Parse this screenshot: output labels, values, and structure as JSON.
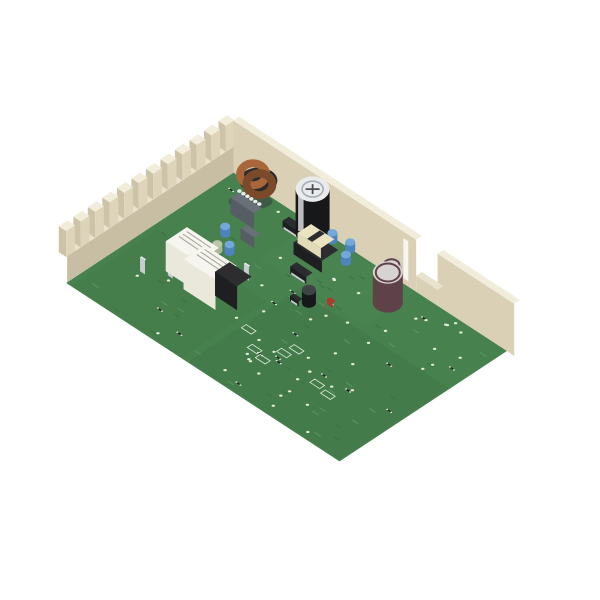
{
  "meta": {
    "alt": "Appliance control circuit board with relays on a green PCB inside a cream crenellated plastic enclosure, photographed on a white background"
  },
  "colors": {
    "background": "#ffffff",
    "wallTop": "#f2ecda",
    "wallTopDim": "#e9e2cd",
    "wallFaceLeft": "#e3dbc5",
    "wallFaceLeftLow": "#dcd3ba",
    "wallFaceRight": "#d6ccb2",
    "wallFaceRightLow": "#cfc5aa",
    "wallInner": "#d9d0b6",
    "wallInnerShadow": "#c8bea3",
    "toothSide": "#cdc3a8",
    "toothInner": "#ddd4ba",
    "railTop": "#eee7d3",
    "ledge": "#f0e9d6",
    "ledgeShadow": "#b8ae93",
    "slotDark": "#26251f",
    "slotShallow": "#6e6753",
    "slotWhite": "#f7f5ee",
    "holeTan": "#c2b89c",
    "tab": "#e6deca",
    "pcb": "#47814e",
    "pcbDark": "#3b7143",
    "pcbLight": "#5c9a63",
    "pad": "#e3ecdd",
    "relayTop": "#f7f5ef",
    "relayWest": "#d8d4c7",
    "relaySouth": "#eae7db",
    "relayText": "#a9a89c",
    "blackTop": "#2d2c2f",
    "blackWest": "#141317",
    "blackSouth": "#1f1e21",
    "grayTop": "#697078",
    "grayWest": "#464b52",
    "graySouth": "#575d64",
    "silver": "#c9cdd1",
    "silverDark": "#9aa0a6",
    "silverTop": "#e7eaec",
    "maroon": "#5e4149",
    "capTop": "#d8d3d3",
    "capTopDark": "#3f4246",
    "blackBody": "#17181a",
    "capTopWhite": "#e9ebec",
    "capRing": "#a8aeb4",
    "capStripe": "#d8dadc",
    "capVent": "#4a4e52",
    "blueCap": "#4c84bd",
    "blueCapTop": "#74a8da",
    "copper": "#a9663a",
    "copperDark": "#7a4a2a",
    "bobbin": "#ebe4c2",
    "bobbinSide": "#d6cfac",
    "bobbinSouth": "#e2dbb8",
    "redConnTop": "#bd4a3c",
    "redConnWest": "#8a2d24",
    "redConnSouth": "#a63728",
    "redTeeth": "#c4564a",
    "redSlab": "#a5382c",
    "redSmall": "#b03a30",
    "redSmallDark": "#7e2a22",
    "darkGreen": "#24382c",
    "darkGreenTop": "#2e4637",
    "darkGreenDark": "#16241c",
    "gold": "#c9a243",
    "qfpTop": "#26272b",
    "soicTop": "#2b2c30",
    "connTop": "#f0ead9",
    "connWest": "#d7d1be",
    "connSouth": "#e5dfcc",
    "connHole": "#3a3831",
    "paleGreen": "#b8c7a5",
    "paleGreenBody": "#a9b897",
    "toroidBase": "#2c2c2a"
  },
  "materials": {
    "relay": [
      "relayTop",
      "relayWest",
      "relaySouth"
    ],
    "blackRelay": [
      "blackTop",
      "blackWest",
      "blackSouth"
    ],
    "gray": [
      "grayTop",
      "grayWest",
      "graySouth"
    ],
    "spade": [
      "silverTop",
      "silverDark",
      "silver"
    ],
    "conn": [
      "connTop",
      "connWest",
      "connSouth"
    ],
    "blackConn": [
      "capTopDark",
      "blackWest",
      "blackSouth"
    ],
    "darkGreen": [
      "darkGreenTop",
      "darkGreenDark",
      "darkGreen"
    ],
    "redSmall": [
      "redSmall",
      "redSmallDark",
      "redSmall"
    ],
    "redConn": [
      "redConnTop",
      "redConnWest",
      "redConnSouth"
    ],
    "soicMat": [
      "soicTop",
      "blackWest",
      "blackSouth"
    ],
    "maroonCap": [
      "capTop",
      "maroon"
    ],
    "blackCap": [
      "capTopDark",
      "blackBody"
    ],
    "blueDisc": [
      "blueCapTop",
      "blueCap"
    ],
    "paleGreenMat": [
      "paleGreen",
      "paleGreenBody"
    ]
  },
  "scene": {
    "projection": {
      "ox": 232,
      "oy": 164,
      "ux": 0.6128,
      "uy": 0.4,
      "vx": -0.4838,
      "vy": 0.3189
    },
    "board": {
      "w": 470,
      "d": 370,
      "wall": 12
    },
    "components": [
      {
        "name": "toroid-inductor",
        "type": "toroid",
        "bx": 62,
        "by": 30
      },
      {
        "name": "film-capacitor-large",
        "type": "box",
        "m": "gray",
        "bx": 80,
        "by": 72,
        "w": 38,
        "d": 16,
        "h": 16
      },
      {
        "name": "film-capacitor-small",
        "type": "box",
        "m": "gray",
        "bx": 112,
        "by": 104,
        "w": 22,
        "d": 12,
        "h": 11
      },
      {
        "name": "electrolytic-capacitor-large",
        "type": "bigcap",
        "bx": 152,
        "by": 26,
        "r": 17,
        "h": 44
      },
      {
        "name": "transformer",
        "type": "transformer",
        "bx": 186,
        "by": 62,
        "w": 46,
        "d": 34,
        "h": 24
      },
      {
        "name": "electrolytic-capacitor-medium",
        "type": "cyl",
        "m": "maroonCap",
        "bx": 300,
        "by": 58,
        "r": 15,
        "h": 30
      },
      {
        "name": "electrolytic-capacitor-small",
        "type": "cyl",
        "m": "maroonCap",
        "bx": 284,
        "by": 30,
        "r": 10,
        "h": 22
      },
      {
        "name": "electrolytic-capacitor-mini",
        "type": "cyl",
        "m": "blackCap",
        "bx": 236,
        "by": 140,
        "r": 7,
        "h": 13
      },
      {
        "name": "connector-black",
        "type": "blackconn",
        "bx": 336,
        "by": 16,
        "w": 34,
        "d": 20,
        "h": 26
      },
      {
        "name": "connector-white-1",
        "type": "whiteconn",
        "bx": 388,
        "by": 34,
        "w": 30,
        "d": 24,
        "h": 24
      },
      {
        "name": "connector-white-2",
        "type": "whiteconn",
        "bx": 428,
        "by": 52,
        "w": 30,
        "d": 24,
        "h": 24
      },
      {
        "name": "connector-white-corner",
        "type": "whiteconn",
        "bx": 440,
        "by": 20,
        "w": 22,
        "d": 18,
        "h": 28
      },
      {
        "name": "component-dark-green",
        "type": "box",
        "m": "darkGreen",
        "bx": 454,
        "by": 40,
        "w": 14,
        "d": 20,
        "h": 16
      },
      {
        "name": "disc-capacitor-blue-1",
        "type": "cyl",
        "m": "blueDisc",
        "bx": 82,
        "by": 118,
        "r": 5,
        "h": 8
      },
      {
        "name": "disc-capacitor-blue-2",
        "type": "cyl",
        "m": "blueDisc",
        "bx": 108,
        "by": 142,
        "r": 5,
        "h": 8
      },
      {
        "name": "disc-capacitor-blue-3",
        "type": "cyl",
        "m": "blueDisc",
        "bx": 178,
        "by": 18,
        "r": 5,
        "h": 8
      },
      {
        "name": "disc-capacitor-blue-4",
        "type": "cyl",
        "m": "blueDisc",
        "bx": 204,
        "by": 14,
        "r": 5,
        "h": 8
      },
      {
        "name": "disc-capacitor-blue-5",
        "type": "cyl",
        "m": "blueDisc",
        "bx": 216,
        "by": 38,
        "r": 5,
        "h": 8
      },
      {
        "name": "ic-soic-1",
        "type": "soic",
        "bx": 134,
        "by": 42,
        "w": 26,
        "d": 13,
        "h": 7
      },
      {
        "name": "ic-soic-2",
        "type": "soic",
        "bx": 197,
        "by": 106,
        "w": 26,
        "d": 13,
        "h": 7
      },
      {
        "name": "ic-soic-3",
        "type": "soic",
        "bx": 293,
        "by": 158,
        "w": 26,
        "d": 13,
        "h": 7
      },
      {
        "name": "ic-soic-4",
        "type": "soic",
        "bx": 225,
        "by": 152,
        "w": 14,
        "d": 8,
        "h": 5
      },
      {
        "name": "microcontroller-qfp",
        "type": "qfp",
        "bx": 358,
        "by": 130,
        "w": 30,
        "d": 30,
        "h": 9
      },
      {
        "name": "pin-header",
        "type": "header",
        "bx": 399,
        "by": 148,
        "w": 30,
        "d": 12,
        "h": 9
      },
      {
        "name": "component-red-1",
        "type": "box",
        "m": "redSmall",
        "bx": 257,
        "by": 120,
        "w": 9,
        "d": 6,
        "h": 5
      },
      {
        "name": "component-red-2",
        "type": "box",
        "m": "redSmall",
        "bx": 380,
        "by": 64,
        "w": 9,
        "d": 6,
        "h": 6
      },
      {
        "name": "resistor-pale-green",
        "type": "cyl",
        "m": "paleGreenMat",
        "bx": 96,
        "by": 152,
        "r": 5,
        "h": 7
      },
      {
        "name": "relay-white-1",
        "type": "relay",
        "m": "relay",
        "bx": 80,
        "by": 345,
        "w": 44,
        "d": 38,
        "h": 28
      },
      {
        "name": "relay-white-2",
        "type": "relay",
        "m": "relay",
        "bx": 106,
        "by": 328,
        "w": 44,
        "d": 38,
        "h": 28
      },
      {
        "name": "relay-white-3",
        "type": "relay",
        "m": "relay",
        "bx": 148,
        "by": 318,
        "w": 44,
        "d": 38,
        "h": 28
      },
      {
        "name": "relay-white-4",
        "type": "relay",
        "m": "relay",
        "bx": 105,
        "by": 215,
        "w": 52,
        "d": 44,
        "h": 30
      },
      {
        "name": "relay-white-5",
        "type": "relay",
        "m": "relay",
        "bx": 142,
        "by": 225,
        "w": 52,
        "d": 44,
        "h": 30
      },
      {
        "name": "relay-white-6",
        "type": "relay",
        "m": "relay",
        "bx": 205,
        "by": 285,
        "w": 46,
        "d": 40,
        "h": 28
      },
      {
        "name": "relay-white-7",
        "type": "relay",
        "m": "relay",
        "bx": 240,
        "by": 302,
        "w": 46,
        "d": 40,
        "h": 28
      },
      {
        "name": "relay-white-8",
        "type": "relay",
        "m": "relay",
        "bx": 262,
        "by": 248,
        "w": 44,
        "d": 38,
        "h": 28
      },
      {
        "name": "relay-white-9",
        "type": "relay",
        "m": "relay",
        "bx": 295,
        "by": 330,
        "w": 46,
        "d": 40,
        "h": 28
      },
      {
        "name": "relay-white-10",
        "type": "relay",
        "m": "relay",
        "bx": 318,
        "by": 275,
        "w": 46,
        "d": 40,
        "h": 28
      },
      {
        "name": "relay-white-11",
        "type": "relay",
        "m": "relay",
        "bx": 345,
        "by": 335,
        "w": 46,
        "d": 40,
        "h": 28
      },
      {
        "name": "relay-white-12",
        "type": "relay",
        "m": "relay",
        "bx": 380,
        "by": 336,
        "w": 46,
        "d": 40,
        "h": 28
      },
      {
        "name": "relay-white-13",
        "type": "relay",
        "m": "relay",
        "bx": 390,
        "by": 200,
        "w": 44,
        "d": 38,
        "h": 28
      },
      {
        "name": "relay-white-14",
        "type": "relay",
        "m": "relay",
        "bx": 428,
        "by": 242,
        "w": 44,
        "d": 38,
        "h": 28
      },
      {
        "name": "relay-white-15",
        "type": "relay",
        "m": "relay",
        "bx": 412,
        "by": 296,
        "w": 46,
        "d": 40,
        "h": 28
      },
      {
        "name": "relay-black-1",
        "type": "relay",
        "m": "blackRelay",
        "bx": 168,
        "by": 210,
        "w": 36,
        "d": 30,
        "h": 24
      },
      {
        "name": "relay-black-2",
        "type": "relay",
        "m": "blackRelay",
        "bx": 222,
        "by": 221,
        "w": 50,
        "d": 42,
        "h": 30
      },
      {
        "name": "relay-black-3",
        "type": "relay",
        "m": "blackRelay",
        "bx": 168,
        "by": 350,
        "w": 50,
        "d": 42,
        "h": 30
      },
      {
        "name": "relay-black-4",
        "type": "relay",
        "m": "blackRelay",
        "bx": 268,
        "by": 296,
        "w": 34,
        "d": 30,
        "h": 22
      },
      {
        "name": "terminal-spade-1",
        "type": "box",
        "m": "spade",
        "bx": 62,
        "by": 262,
        "w": 8,
        "d": 3,
        "h": 14
      },
      {
        "name": "terminal-spade-2",
        "type": "box",
        "m": "spade",
        "bx": 90,
        "by": 240,
        "w": 8,
        "d": 3,
        "h": 14
      },
      {
        "name": "terminal-spade-3",
        "type": "box",
        "m": "spade",
        "bx": 122,
        "by": 200,
        "w": 8,
        "d": 3,
        "h": 14
      },
      {
        "name": "terminal-spade-4",
        "type": "box",
        "m": "spade",
        "bx": 155,
        "by": 165,
        "w": 8,
        "d": 3,
        "h": 14
      },
      {
        "name": "terminal-spade-5",
        "type": "box",
        "m": "spade",
        "bx": 200,
        "by": 252,
        "w": 8,
        "d": 3,
        "h": 14
      },
      {
        "name": "terminal-spade-6",
        "type": "box",
        "m": "spade",
        "bx": 178,
        "by": 300,
        "w": 8,
        "d": 3,
        "h": 14
      },
      {
        "name": "terminal-spade-7",
        "type": "box",
        "m": "spade",
        "bx": 224,
        "by": 338,
        "w": 8,
        "d": 3,
        "h": 14
      },
      {
        "name": "terminal-spade-8",
        "type": "box",
        "m": "spade",
        "bx": 256,
        "by": 312,
        "w": 8,
        "d": 3,
        "h": 14
      },
      {
        "name": "terminal-spade-9",
        "type": "box",
        "m": "spade",
        "bx": 308,
        "by": 318,
        "w": 8,
        "d": 3,
        "h": 14
      },
      {
        "name": "terminal-spade-10",
        "type": "box",
        "m": "spade",
        "bx": 338,
        "by": 290,
        "w": 8,
        "d": 3,
        "h": 14
      },
      {
        "name": "terminal-spade-11",
        "type": "box",
        "m": "spade",
        "bx": 282,
        "by": 230,
        "w": 8,
        "d": 3,
        "h": 14
      },
      {
        "name": "terminal-spade-12",
        "type": "box",
        "m": "spade",
        "bx": 312,
        "by": 240,
        "w": 8,
        "d": 3,
        "h": 14
      }
    ],
    "frontComponents": [
      {
        "name": "connector-red",
        "type": "redconn",
        "bx": 428,
        "by": 314,
        "w": 46,
        "d": 26,
        "h": 18
      }
    ]
  }
}
